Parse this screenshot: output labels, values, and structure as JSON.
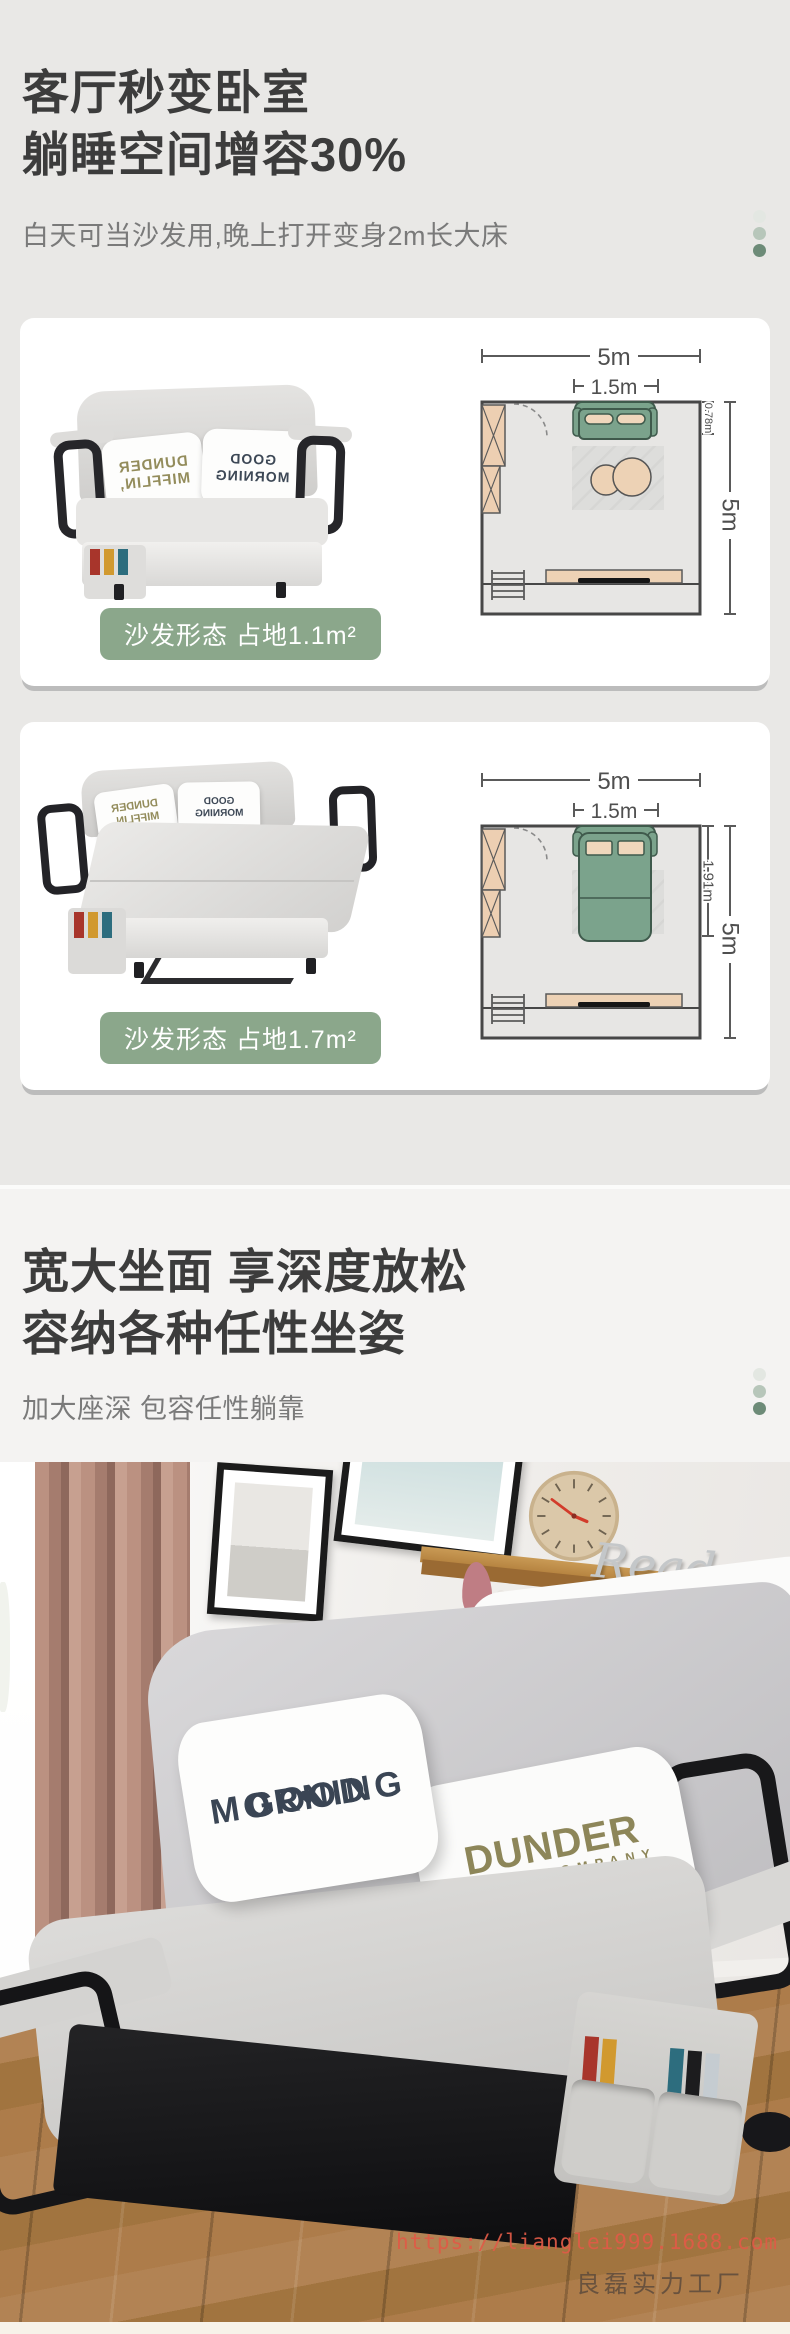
{
  "hero": {
    "title_line1": "客厅秒变卧室",
    "title_line2": "躺睡空间增容30%",
    "subtitle": "白天可当沙发用,晚上打开变身2m长大床"
  },
  "cards": [
    {
      "badge": "沙发形态 占地1.1m²",
      "plan": {
        "room_width": "5m",
        "sofa_width": "1.5m",
        "sofa_depth": "0.78m",
        "room_depth": "5m"
      }
    },
    {
      "badge": "沙发形态 占地1.7m²",
      "plan": {
        "room_width": "5m",
        "sofa_width": "1.5m",
        "sofa_depth": "1.91m",
        "room_depth": "5m"
      }
    }
  ],
  "seating": {
    "title_line1": "宽大坐面 享深度放松",
    "title_line2": "容纳各种任性坐姿",
    "subtitle": "加大座深 包容任性躺靠"
  },
  "pillows": {
    "good_heart": "♥",
    "good_line1": "GOOD",
    "good_line2": "MORNING",
    "dunder_line1": "DUNDER",
    "dunder_line2": "MIFFLIN,",
    "dunder_inc": "INC",
    "dunder_line3": "PAPER COMPANY"
  },
  "decor": {
    "shelf_word": "Read"
  },
  "watermark": {
    "url": "https://lianglei999.1688.com",
    "brand": "良磊实力工厂"
  },
  "colors": {
    "page_bg": "#e9e8e6",
    "section2_bg": "#f4f3f2",
    "badge_green": "#8ba78b",
    "plan_sofa_green": "#7ba38c",
    "dot_green_dark": "#6d8b78",
    "watermark_red": "#e06a55"
  }
}
